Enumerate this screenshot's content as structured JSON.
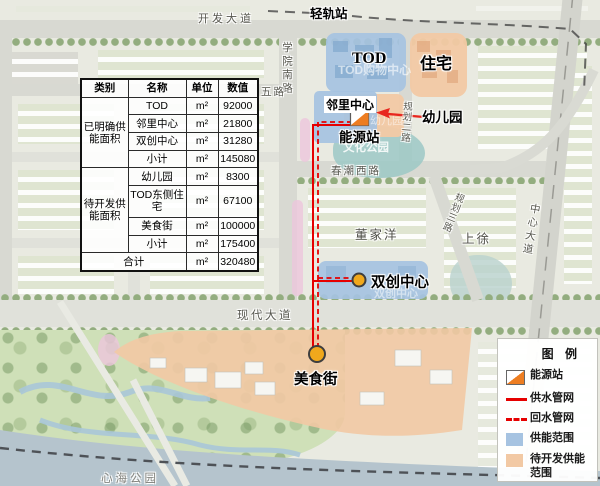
{
  "map": {
    "roads": {
      "kaifa": "开发大道",
      "qinggui": "轻轨站",
      "xueyuan": "学院南路",
      "wulu": "五路",
      "chunchao": "春潮西路",
      "guihua2": "规划二路",
      "guihua3": "规划三路",
      "zhongxin": "中心大道",
      "xiandai": "现代大道"
    },
    "places": {
      "dongjiayang": "董家洋",
      "shangxu": "上徐",
      "xinhai": "心海公园"
    },
    "annotations": {
      "tod": "TOD",
      "zhuzhai": "住宅",
      "linli": "邻里中心",
      "youeryuan": "幼儿园",
      "nengyuanzhan": "能源站",
      "shuangchuang": "双创中心",
      "meishijie": "美食街"
    },
    "watermarks": {
      "tod_mall": "TOD购物中心",
      "wenhua": "文化公园",
      "youeryuan": "幼儿园",
      "shuangchuang": "双创中心"
    }
  },
  "table": {
    "headers": {
      "category": "类别",
      "name": "名称",
      "unit": "单位",
      "value": "数值"
    },
    "groups": [
      {
        "category": "已明确供能面积",
        "rows": [
          {
            "name": "TOD",
            "unit": "m²",
            "value": "92000"
          },
          {
            "name": "邻里中心",
            "unit": "m²",
            "value": "21800"
          },
          {
            "name": "双创中心",
            "unit": "m²",
            "value": "31280"
          },
          {
            "name": "小计",
            "unit": "m²",
            "value": "145080"
          }
        ]
      },
      {
        "category": "待开发供能面积",
        "rows": [
          {
            "name": "幼儿园",
            "unit": "m²",
            "value": "8300"
          },
          {
            "name": "TOD东侧住宅",
            "unit": "m²",
            "value": "67100"
          },
          {
            "name": "美食街",
            "unit": "m²",
            "value": "100000"
          },
          {
            "name": "小计",
            "unit": "m²",
            "value": "175400"
          }
        ]
      }
    ],
    "total": {
      "label": "合计",
      "unit": "m²",
      "value": "320480"
    }
  },
  "legend": {
    "title": "图 例",
    "items": [
      {
        "label": "能源站"
      },
      {
        "label": "供水管网"
      },
      {
        "label": "回水管网"
      },
      {
        "label": "供能范围"
      },
      {
        "label": "待开发供能范围"
      }
    ]
  },
  "colors": {
    "supply_area": "#a6c3e1",
    "pending_area": "#f2c9a4",
    "energy_station": "#ed7d21",
    "pipe": "#e60000",
    "marker": "#f0a81c"
  }
}
